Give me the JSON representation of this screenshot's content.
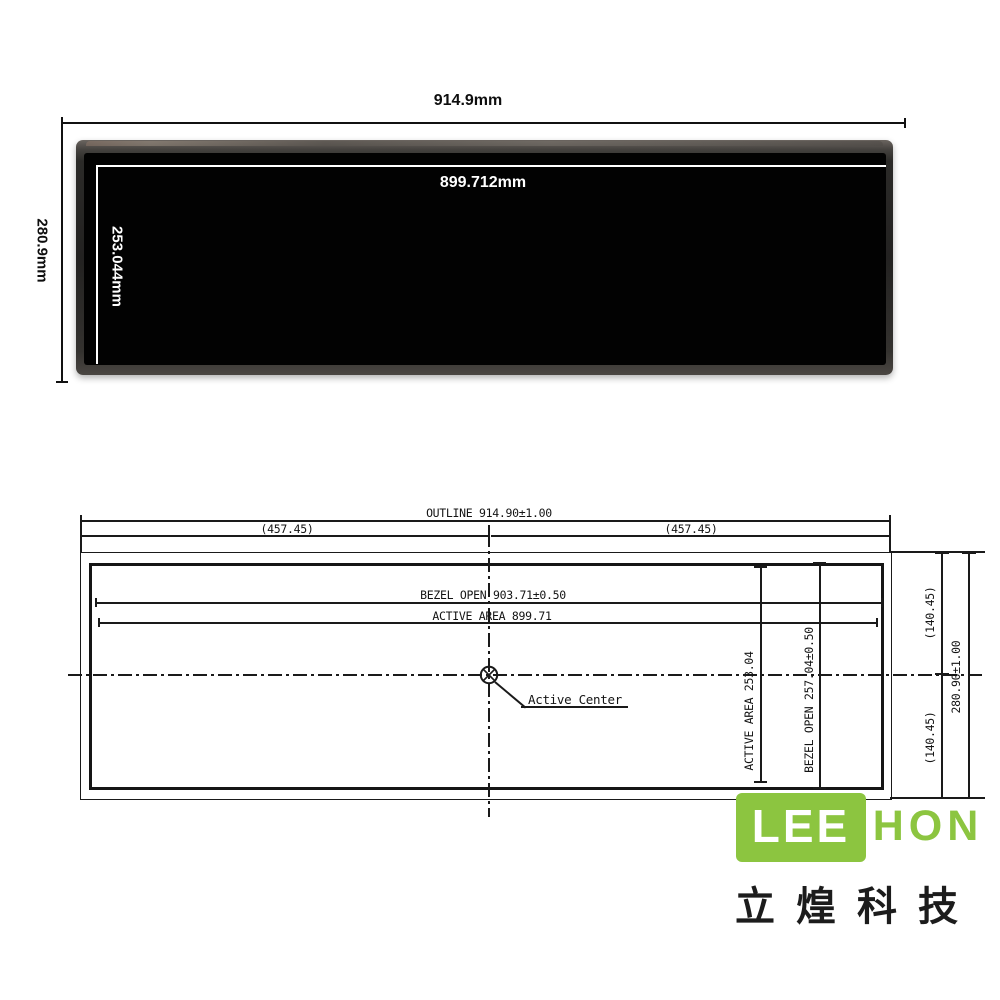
{
  "photo": {
    "outline_width": "914.9mm",
    "outline_height": "280.9mm",
    "active_width": "899.712mm",
    "active_height": "253.044mm"
  },
  "drawing": {
    "outline_width_dim": "OUTLINE 914.90±1.00",
    "half_width_left": "(457.45)",
    "half_width_right": "(457.45)",
    "bezel_open_width_dim": "BEZEL OPEN 903.71±0.50",
    "active_area_width_dim": "ACTIVE AREA 899.71",
    "active_center_label": "Active Center",
    "active_area_height_dim": "ACTIVE AREA 253.04",
    "bezel_open_height_dim": "BEZEL OPEN 257.04±0.50",
    "half_height_top": "(140.45)",
    "half_height_bottom": "(140.45)",
    "outline_height_dim": "280.90±1.00"
  },
  "logo": {
    "lee": "LEE",
    "hon": "HON",
    "subtitle": "立煌科技"
  },
  "colors": {
    "brand_green": "#8CC540",
    "line_black": "#1a1a1a",
    "screen_black": "#020202"
  }
}
